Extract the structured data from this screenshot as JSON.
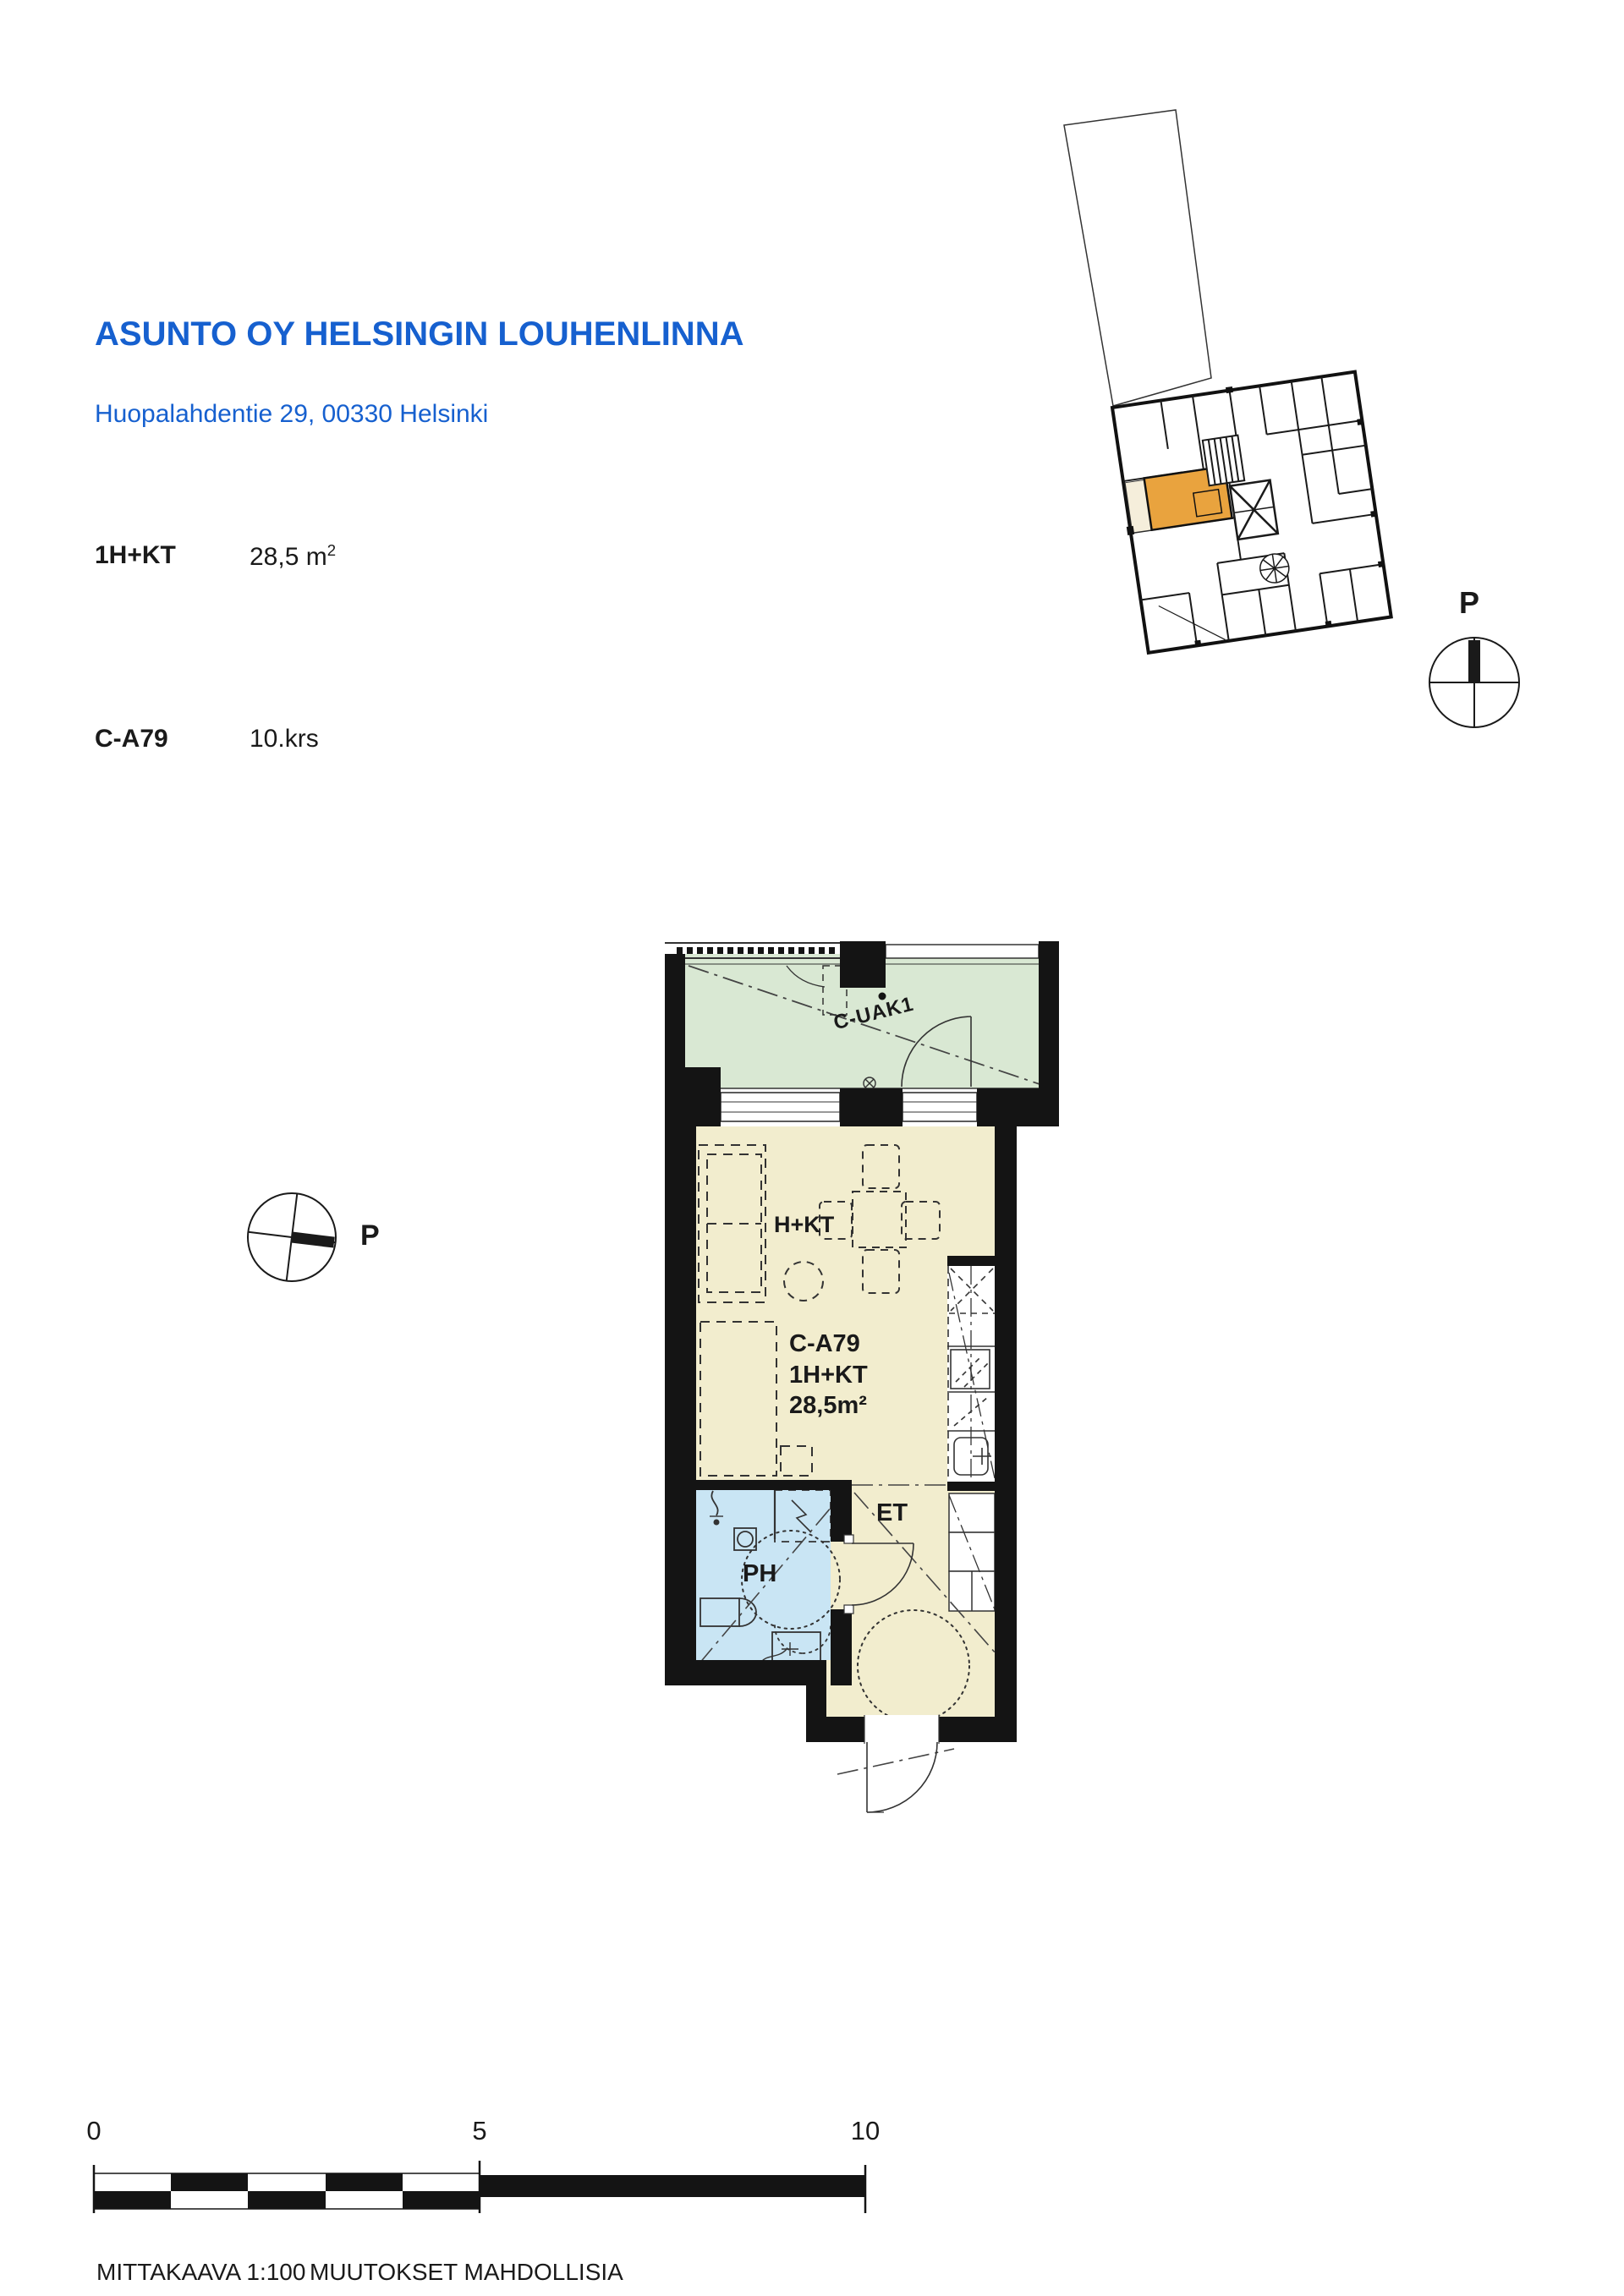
{
  "header": {
    "title": "ASUNTO OY HELSINGIN LOUHENLINNA",
    "address": "Huopalahdentie 29, 00330 Helsinki",
    "unit_type_label": "1H+KT",
    "area_value": "28,5 m",
    "area_exponent": "2",
    "unit_id": "C-A79",
    "floor": "10.krs"
  },
  "plan": {
    "balcony_label": "C-UAK1",
    "room_label": "H+KT",
    "unit_id": "C-A79",
    "unit_type": "1H+KT",
    "unit_area": "28,5m²",
    "bathroom_label": "PH",
    "hall_label": "ET"
  },
  "compass": {
    "north_label": "P",
    "site_north_label": "P"
  },
  "scale_bar": {
    "start": "0",
    "middle": "5",
    "end": "10"
  },
  "footer": {
    "scale_text": "MITTAKAAVA 1:100",
    "disclaimer": "MUUTOKSET MAHDOLLISIA"
  },
  "colors": {
    "accent_blue": "#1660cf",
    "balcony_green": "#d9e8d3",
    "room_beige": "#f2edce",
    "bathroom_blue": "#c9e5f4",
    "highlight_orange": "#e9a33e",
    "highlight_cream": "#f5eedb",
    "wall_black": "#141414"
  }
}
